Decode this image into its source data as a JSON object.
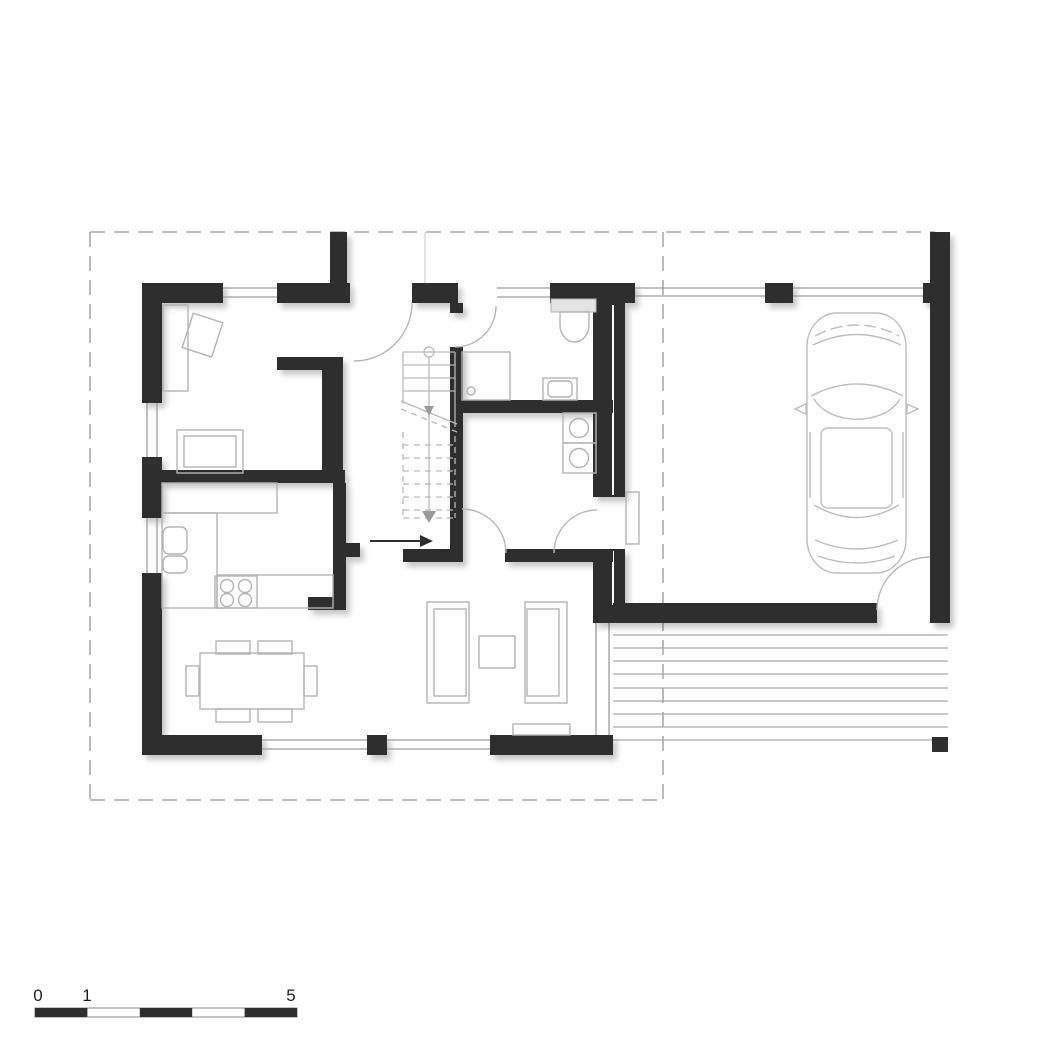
{
  "scale_bar": {
    "labels": [
      "0",
      "1",
      "5"
    ],
    "segment_count": 5,
    "pattern": "alternating black and white segments"
  },
  "theme": {
    "wall-color": "#2e2e2e",
    "furniture-line": "#b3b3b3",
    "window-line": "#9c9c9c",
    "boundary-line": "#a9a9a9",
    "terrace-line": "#a9a9a9",
    "car-line": "#bdbdbd",
    "stair-line": "#b9b9b9",
    "text-color": "#1c1c1c",
    "background": "#ffffff"
  }
}
